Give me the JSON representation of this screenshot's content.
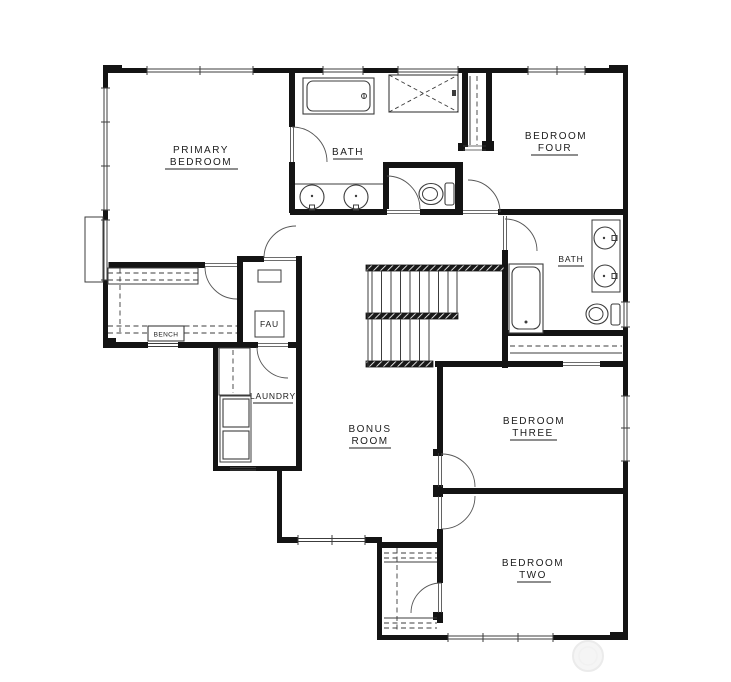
{
  "floor_plan": {
    "rooms": [
      {
        "id": "primary-bedroom",
        "lines": [
          "PRIMARY",
          "BEDROOM"
        ]
      },
      {
        "id": "primary-bath",
        "lines": [
          "BATH"
        ]
      },
      {
        "id": "bedroom-four",
        "lines": [
          "BEDROOM",
          "FOUR"
        ]
      },
      {
        "id": "hall-bath",
        "lines": [
          "BATH"
        ]
      },
      {
        "id": "walk-in-closet-bench",
        "lines": [
          "BENCH"
        ]
      },
      {
        "id": "fau-closet",
        "lines": [
          "FAU"
        ]
      },
      {
        "id": "laundry",
        "lines": [
          "LAUNDRY"
        ]
      },
      {
        "id": "bonus-room",
        "lines": [
          "BONUS",
          "ROOM"
        ]
      },
      {
        "id": "bedroom-three",
        "lines": [
          "BEDROOM",
          "THREE"
        ]
      },
      {
        "id": "bedroom-two",
        "lines": [
          "BEDROOM",
          "TWO"
        ]
      }
    ],
    "fixtures": [
      "bathtub",
      "shower",
      "double-vanity-sinks",
      "toilet",
      "bathtub",
      "vanity-sinks",
      "toilet",
      "washer-dryer",
      "bench",
      "fau-unit",
      "switchback-stairs"
    ],
    "colors": {
      "wall": "#141414",
      "line": "#3c3c3c",
      "label": "#1c1c1c",
      "background": "#ffffff",
      "watermark": "#efefef"
    }
  }
}
